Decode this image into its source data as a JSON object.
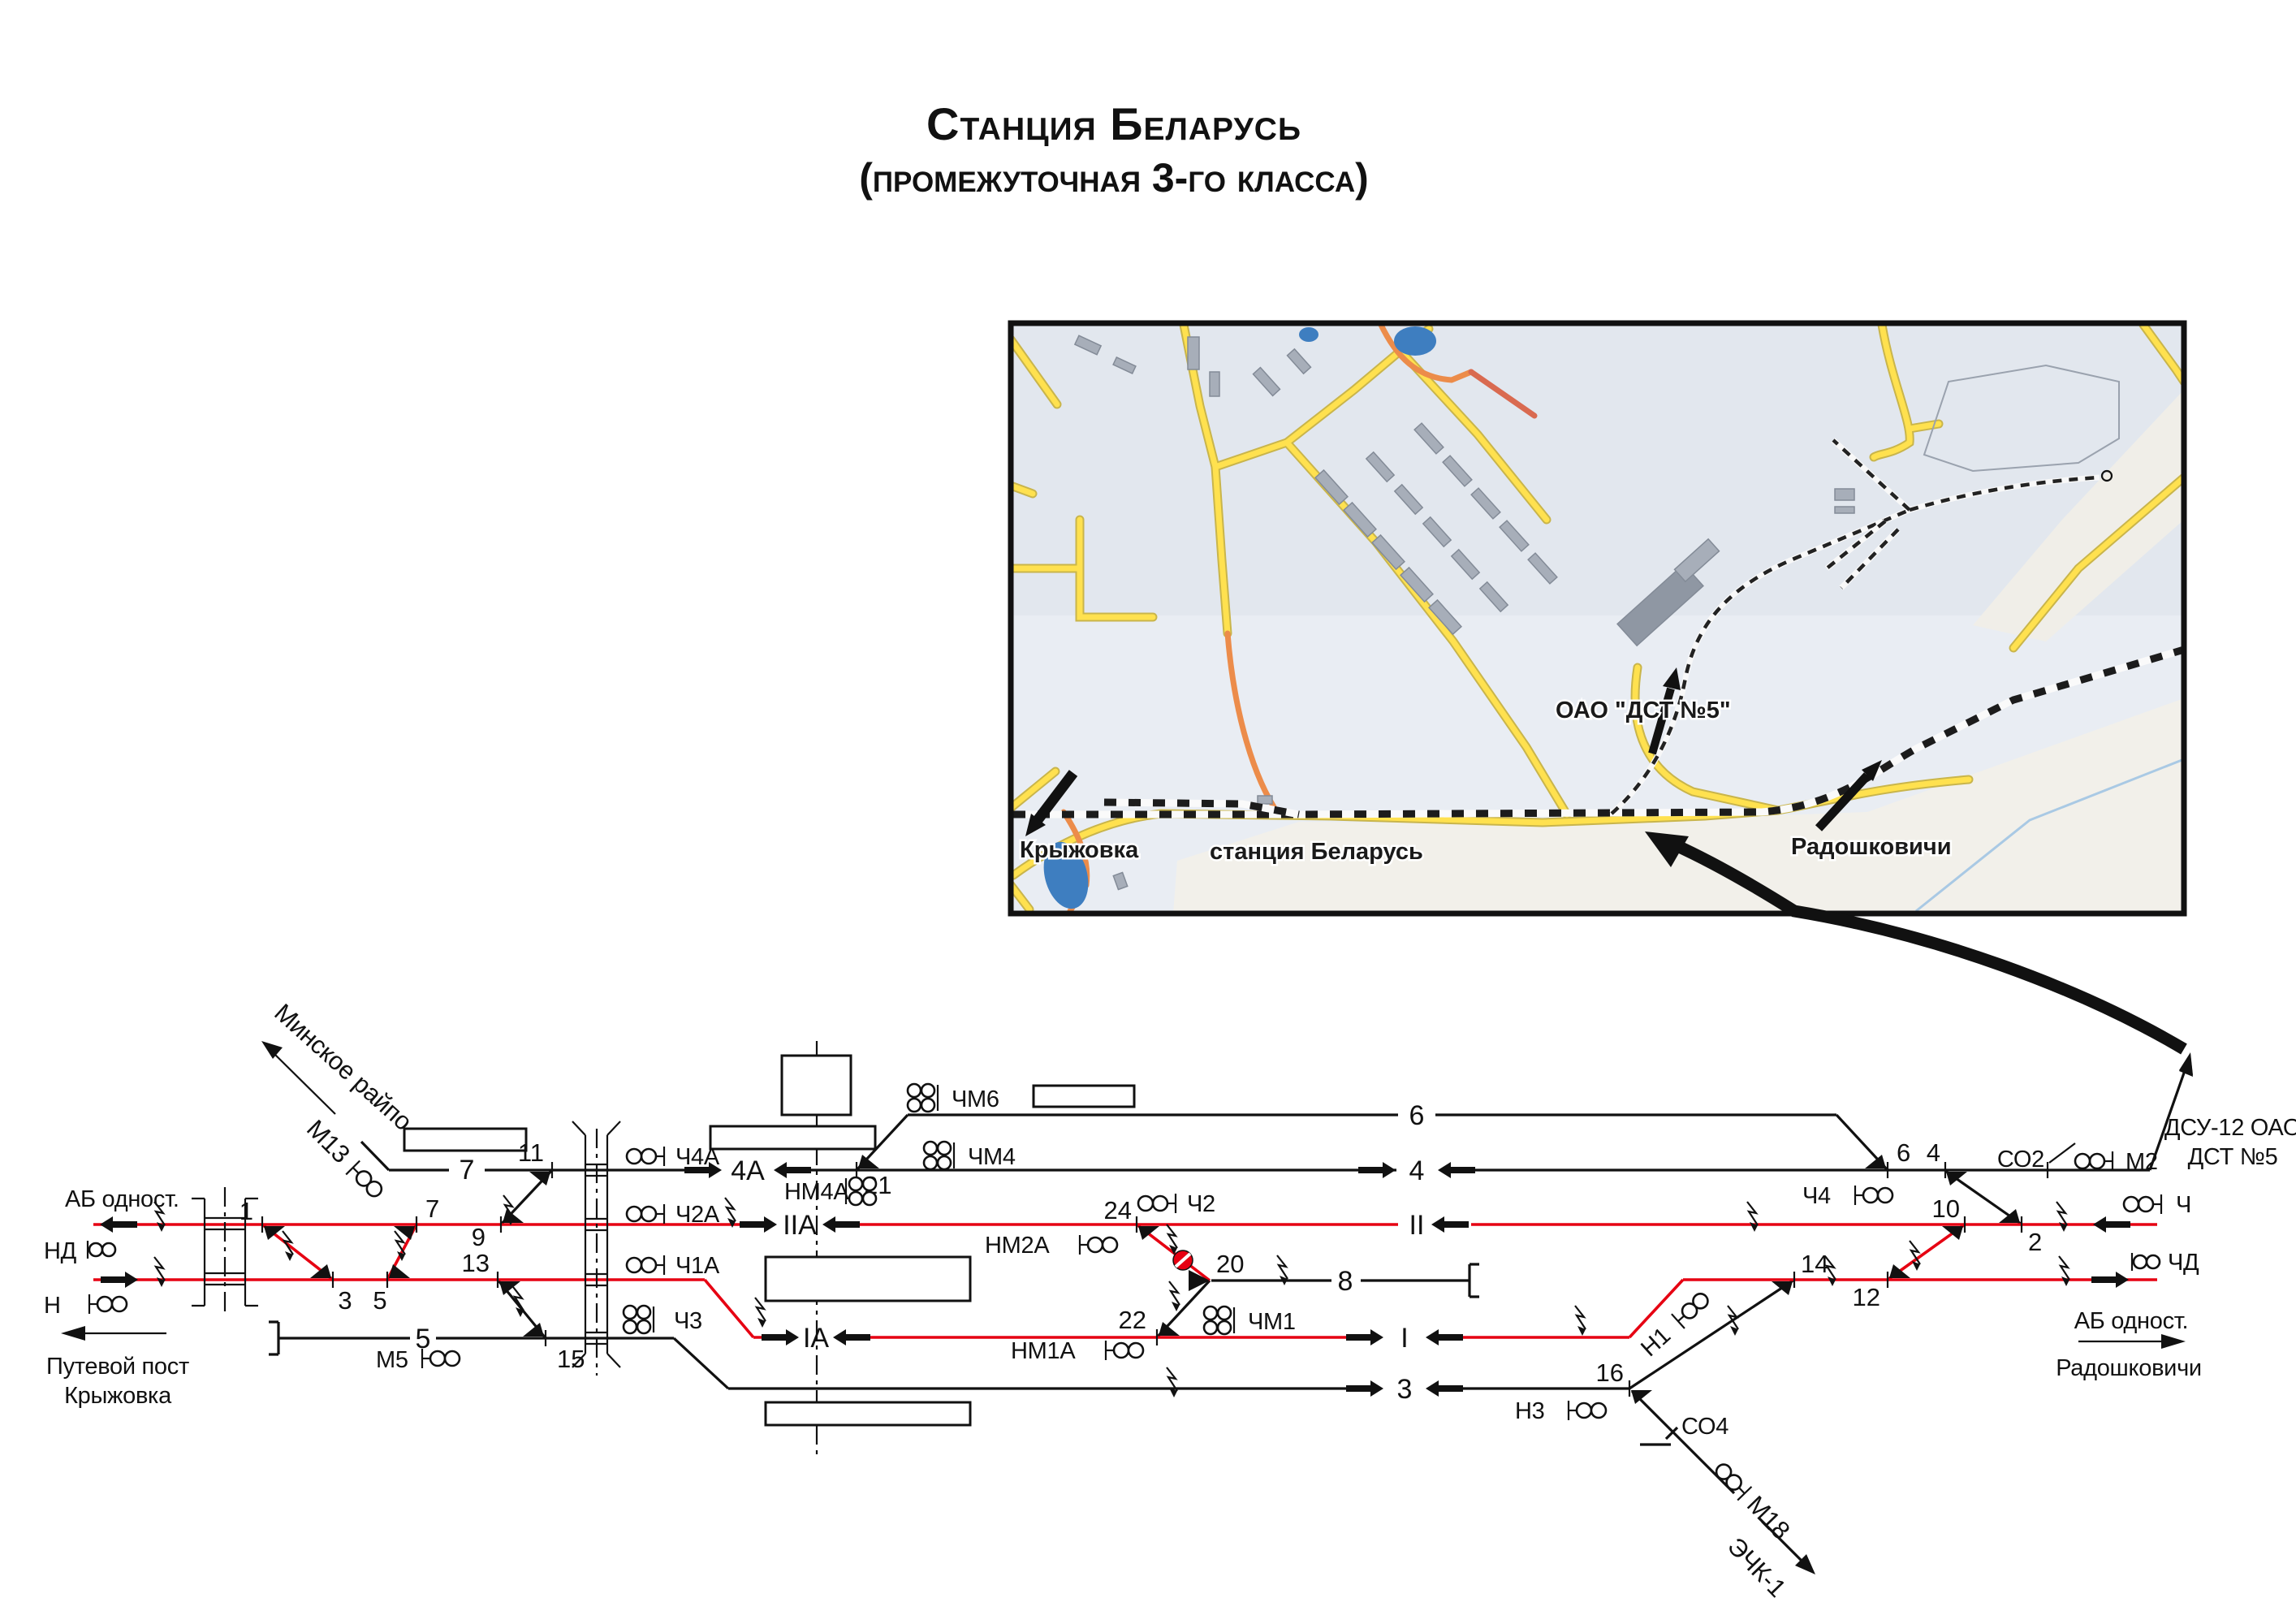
{
  "title": {
    "line1": "Станция Беларусь",
    "line2": "(промежуточная 3-го класса)"
  },
  "map": {
    "labels": {
      "kryzhovka": "Крыжовка",
      "station": "станция Беларусь",
      "radoshkovichi": "Радошковичи",
      "dst": "ОАО \"ДСТ №5\""
    }
  },
  "scheme": {
    "left": {
      "ab": "АБ одност.",
      "nd": "НД",
      "n": "Н",
      "post1": "Путевой пост",
      "post2": "Крыжовка"
    },
    "minsk_branch": {
      "dest": "Минское райпо",
      "m13": "М13"
    },
    "right": {
      "ab": "АБ одност.",
      "dest": "Радошковичи",
      "ch": "Ч",
      "chd": "ЧД",
      "dsu1": "ДСУ-12 ОАО",
      "dsu2": "ДСТ №5",
      "m2": "М2",
      "so2": "СО2"
    },
    "eck_branch": {
      "so4": "СО4",
      "m18": "М18",
      "eck": "ЭЧК-1"
    },
    "tracks": {
      "t7": "7",
      "t6": "6",
      "t5": "5",
      "t8": "8",
      "t4a": "4А",
      "t4": "4",
      "t2a": "IIА",
      "t2": "II",
      "t1a": "IА",
      "t1": "I",
      "t3": "3"
    },
    "switches": {
      "s1": "1",
      "s2": "2",
      "s3": "3",
      "s4": "4",
      "s5": "5",
      "s6": "6",
      "s7": "7",
      "s9": "9",
      "s10": "10",
      "s11": "11",
      "s12": "12",
      "s13": "13",
      "s14": "14",
      "s15": "15",
      "s16": "16",
      "s20": "20",
      "s21": "21",
      "s22": "22",
      "s24": "24"
    },
    "signals": {
      "ch4a": "Ч4А",
      "ch2a": "Ч2А",
      "ch1a": "Ч1А",
      "ch3": "Ч3",
      "chm6": "ЧМ6",
      "chm4": "ЧМ4",
      "chm1": "ЧМ1",
      "nm4a": "НМ4А",
      "nm2a": "НМ2А",
      "nm1a": "НМ1А",
      "ch2": "Ч2",
      "ch4": "Ч4",
      "n1": "Н1",
      "n3": "Н3",
      "m5": "М5"
    }
  },
  "colors": {
    "track_red": "#e60012",
    "track_black": "#111111",
    "map_road_yellow": "#ffe14f",
    "map_building_gray": "#a7aeb9",
    "map_water_blue": "#3e7ec0",
    "red_dot": "#e60012"
  }
}
